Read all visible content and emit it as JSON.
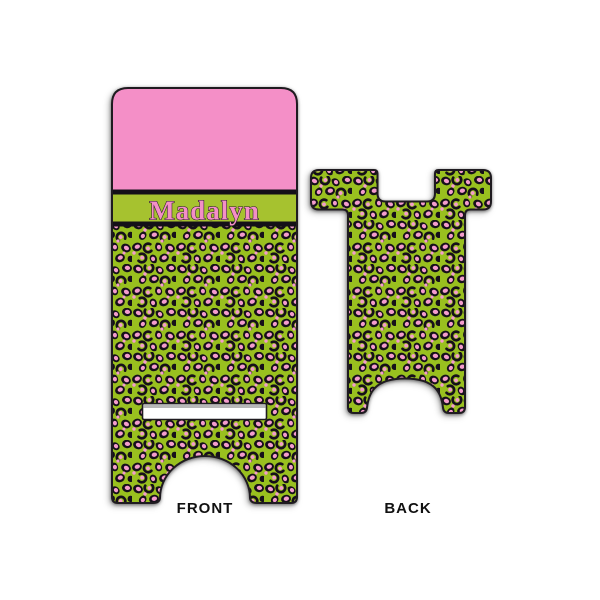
{
  "page": {
    "background": "#ffffff"
  },
  "product": {
    "type": "personalized-phone-stand-mockup",
    "name_text": "Madalyn",
    "pattern_style": "pink-and-lime-leopard-print",
    "views": {
      "front_label": "FRONT",
      "back_label": "BACK"
    }
  },
  "colors": {
    "top_pink": "#f48fc7",
    "band_green": "#a6c22f",
    "divider_black": "#141018",
    "pattern_green": "#99c01f",
    "pattern_pink": "#f49ccc",
    "pattern_black": "#16101a",
    "edge_outline": "#1f1b20",
    "slot_white": "#ffffff",
    "label_text": "#111111"
  }
}
